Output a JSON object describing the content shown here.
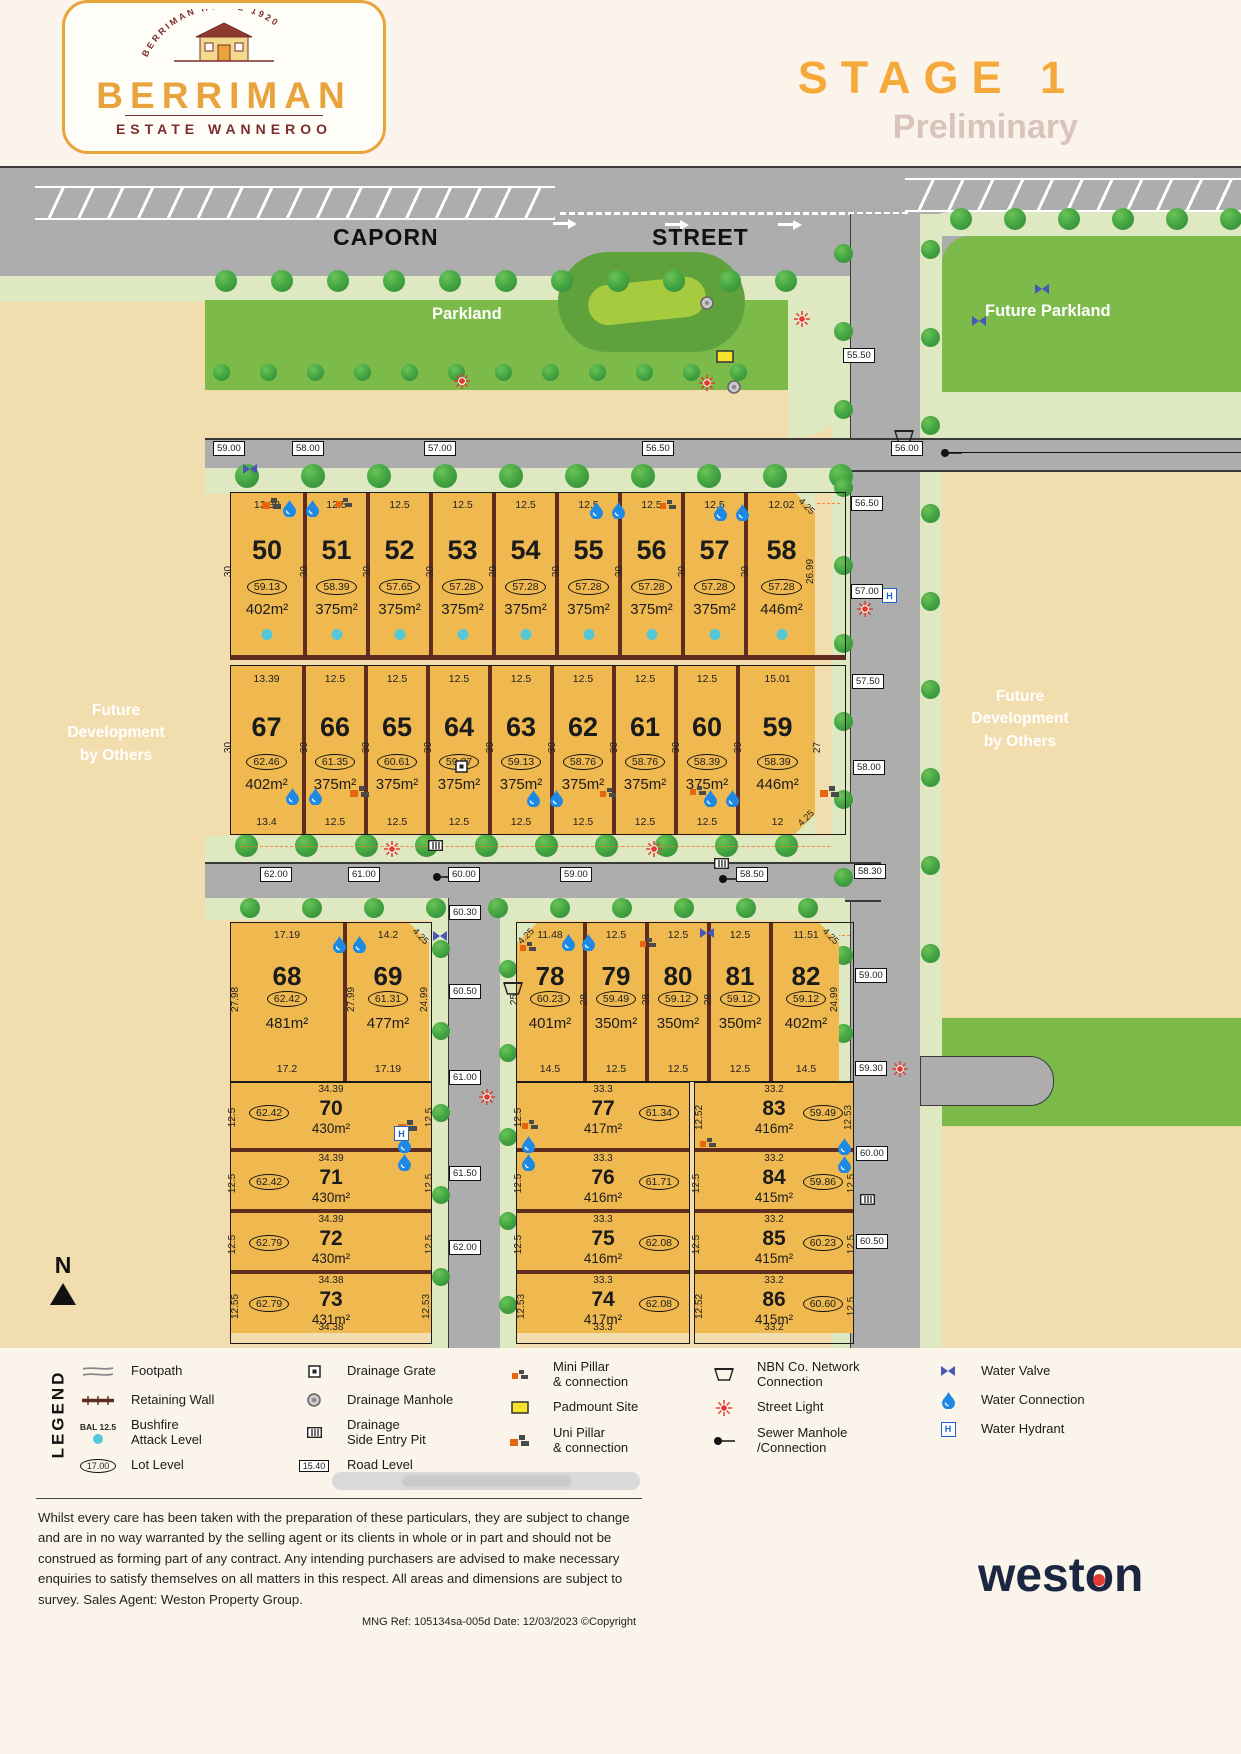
{
  "header": {
    "logo": {
      "arc_text": "BERRIMAN HOUSE 1920",
      "name": "BERRIMAN",
      "subtitle": "ESTATE WANNEROO"
    },
    "stage_title": "STAGE 1",
    "status": "Preliminary"
  },
  "streets": {
    "name_left": "CAPORN",
    "name_right": "STREET"
  },
  "labels": {
    "parkland": "Parkland",
    "future_parkland": "Future Parkland",
    "future_dev": [
      "Future",
      "Development",
      "by Others"
    ],
    "north": "N"
  },
  "road_levels": {
    "ne": "55.50",
    "top_road": [
      "59.00",
      "58.00",
      "57.00",
      "56.50",
      "56.00"
    ],
    "right_road": [
      "56.50",
      "57.00",
      "57.50",
      "58.00",
      "58.30",
      "59.00",
      "59.30",
      "60.00",
      "60.50"
    ],
    "mid_road": [
      "62.00",
      "61.00",
      "60.00",
      "59.00",
      "58.50"
    ],
    "central_road": [
      "60.30",
      "60.50",
      "61.00",
      "61.50",
      "62.00"
    ]
  },
  "lots": {
    "row_top": [
      {
        "num": "50",
        "top": "13.38",
        "left_side": "30",
        "level": "59.13",
        "area": "402m²"
      },
      {
        "num": "51",
        "top": "12.5",
        "left_side": "30",
        "level": "58.39",
        "area": "375m²"
      },
      {
        "num": "52",
        "top": "12.5",
        "left_side": "30",
        "level": "57.65",
        "area": "375m²"
      },
      {
        "num": "53",
        "top": "12.5",
        "left_side": "30",
        "level": "57.28",
        "area": "375m²"
      },
      {
        "num": "54",
        "top": "12.5",
        "left_side": "30",
        "level": "57.28",
        "area": "375m²"
      },
      {
        "num": "55",
        "top": "12.5",
        "left_side": "30",
        "level": "57.28",
        "area": "375m²"
      },
      {
        "num": "56",
        "top": "12.5",
        "left_side": "30",
        "level": "57.28",
        "area": "375m²"
      },
      {
        "num": "57",
        "top": "12.5",
        "left_side": "30",
        "level": "57.28",
        "area": "375m²"
      },
      {
        "num": "58",
        "top": "12.02",
        "left_side": "30",
        "right_side": "26.99",
        "corner": "4.25",
        "corner_pos": "tr",
        "level": "57.28",
        "area": "446m²"
      }
    ],
    "row_second": [
      {
        "num": "67",
        "top": "13.39",
        "bottom": "13.4",
        "left_side": "30",
        "right_side": "30",
        "level": "62.46",
        "area": "402m²"
      },
      {
        "num": "66",
        "top": "12.5",
        "bottom": "12.5",
        "right_side": "30",
        "level": "61.35",
        "area": "375m²"
      },
      {
        "num": "65",
        "top": "12.5",
        "bottom": "12.5",
        "right_side": "30",
        "level": "60.61",
        "area": "375m²"
      },
      {
        "num": "64",
        "top": "12.5",
        "bottom": "12.5",
        "right_side": "30",
        "level": "59.87",
        "area": "375m²"
      },
      {
        "num": "63",
        "top": "12.5",
        "bottom": "12.5",
        "right_side": "30",
        "level": "59.13",
        "area": "375m²"
      },
      {
        "num": "62",
        "top": "12.5",
        "bottom": "12.5",
        "right_side": "30",
        "level": "58.76",
        "area": "375m²"
      },
      {
        "num": "61",
        "top": "12.5",
        "bottom": "12.5",
        "right_side": "30",
        "level": "58.76",
        "area": "375m²"
      },
      {
        "num": "60",
        "top": "12.5",
        "bottom": "12.5",
        "right_side": "30",
        "level": "58.39",
        "area": "375m²"
      },
      {
        "num": "59",
        "top": "15.01",
        "bottom": "12",
        "right_side": "27",
        "corner": "4.25",
        "corner_pos": "br",
        "level": "58.39",
        "area": "446m²"
      }
    ],
    "block_68_69": [
      {
        "num": "68",
        "top": "17.19",
        "bottom": "17.2",
        "left_side": "27.98",
        "level": "62.42",
        "area": "481m²"
      },
      {
        "num": "69",
        "top": "14.2",
        "bottom": "17.19",
        "left_side": "27.99",
        "right_side": "24.99",
        "corner": "4.25",
        "corner_pos": "tr",
        "level": "61.31",
        "area": "477m²"
      }
    ],
    "row_78_82": [
      {
        "num": "78",
        "top": "11.48",
        "bottom": "14.5",
        "left_side": "25",
        "corner": "4.25",
        "corner_pos": "tl",
        "level": "60.23",
        "area": "401m²"
      },
      {
        "num": "79",
        "top": "12.5",
        "bottom": "12.5",
        "left_side": "28",
        "level": "59.49",
        "area": "350m²"
      },
      {
        "num": "80",
        "top": "12.5",
        "bottom": "12.5",
        "left_side": "28",
        "level": "59.12",
        "area": "350m²"
      },
      {
        "num": "81",
        "top": "12.5",
        "bottom": "12.5",
        "left_side": "28",
        "level": "59.12",
        "area": "350m²"
      },
      {
        "num": "82",
        "top": "11.51",
        "bottom": "14.5",
        "right_side": "24.99",
        "corner": "4.25",
        "corner_pos": "tr",
        "level": "59.12",
        "area": "402m²"
      }
    ],
    "col_left": [
      {
        "num": "70",
        "top": "34.39",
        "left_side": "12.5",
        "right_side": "12.5",
        "level": "62.42",
        "area": "430m²"
      },
      {
        "num": "71",
        "top": "34.39",
        "left_side": "12.5",
        "right_side": "12.5",
        "level": "62.42",
        "area": "430m²"
      },
      {
        "num": "72",
        "top": "34.39",
        "left_side": "12.5",
        "right_side": "12.5",
        "level": "62.79",
        "area": "430m²"
      },
      {
        "num": "73",
        "top": "34.38",
        "bottom": "34.38",
        "left_side": "12.55",
        "right_side": "12.53",
        "level": "62.79",
        "area": "431m²"
      }
    ],
    "col_center": [
      {
        "num": "77",
        "top": "33.3",
        "left_side": "12.5",
        "level": "61.34",
        "area": "417m²"
      },
      {
        "num": "76",
        "top": "33.3",
        "left_side": "12.5",
        "level": "61.71",
        "area": "416m²"
      },
      {
        "num": "75",
        "top": "33.3",
        "left_side": "12.5",
        "level": "62.08",
        "area": "416m²"
      },
      {
        "num": "74",
        "top": "33.3",
        "bottom": "33.3",
        "left_side": "12.53",
        "level": "62.08",
        "area": "417m²"
      }
    ],
    "col_right": [
      {
        "num": "83",
        "top": "33.2",
        "left_side": "12.52",
        "right_side": "12.53",
        "level": "59.49",
        "area": "416m²"
      },
      {
        "num": "84",
        "top": "33.2",
        "left_side": "12.5",
        "right_side": "12.5",
        "level": "59.86",
        "area": "415m²"
      },
      {
        "num": "85",
        "top": "33.2",
        "left_side": "12.5",
        "right_side": "12.5",
        "level": "60.23",
        "area": "415m²"
      },
      {
        "num": "86",
        "top": "33.2",
        "bottom": "33.2",
        "left_side": "12.52",
        "right_side": "12.5",
        "level": "60.60",
        "area": "415m²"
      }
    ]
  },
  "legend": {
    "title": "LEGEND",
    "columns": [
      [
        {
          "icon": "footpath-icon",
          "label": "Footpath"
        },
        {
          "icon": "retaining-wall-icon",
          "label": "Retaining Wall"
        },
        {
          "icon": "bal-icon",
          "pre": "BAL 12.5",
          "label": "Bushfire\nAttack Level"
        },
        {
          "icon": "lot-level-icon",
          "badge": "17.00",
          "label": "Lot Level"
        }
      ],
      [
        {
          "icon": "drainage-grate-icon",
          "label": "Drainage Grate"
        },
        {
          "icon": "drainage-manhole-icon",
          "label": "Drainage Manhole"
        },
        {
          "icon": "drainage-sep-icon",
          "label": "Drainage\nSide Entry Pit"
        },
        {
          "icon": "road-level-icon",
          "badge": "15.40",
          "label": "Road Level"
        }
      ],
      [
        {
          "icon": "mini-pillar-icon",
          "label": "Mini Pillar\n& connection"
        },
        {
          "icon": "padmount-icon",
          "label": "Padmount Site"
        },
        {
          "icon": "uni-pillar-icon",
          "label": "Uni Pillar\n& connection"
        }
      ],
      [
        {
          "icon": "nbn-icon",
          "label": "NBN Co. Network\nConnection"
        },
        {
          "icon": "street-light-icon",
          "label": "Street Light"
        },
        {
          "icon": "sewer-icon",
          "label": "Sewer Manhole\n/Connection"
        }
      ],
      [
        {
          "icon": "water-valve-icon",
          "label": "Water Valve"
        },
        {
          "icon": "water-connection-icon",
          "label": "Water Connection"
        },
        {
          "icon": "water-hydrant-icon",
          "label": "Water Hydrant"
        }
      ]
    ]
  },
  "footer": {
    "disclaimer": "Whilst every care has been taken with the preparation of these particulars, they are subject to change and are in no way warranted by the selling agent or its clients in whole or in part and should not be construed as forming part of any contract. Any intending purchasers are advised to make necessary enquiries to satisfy themselves on all matters in this respect. All areas and dimensions are subject to survey. Sales Agent: Weston Property Group.",
    "ref": "MNG Ref: 105134sa-005d   Date: 12/03/2023   ©Copyright",
    "brand_west": "west",
    "brand_o": "o",
    "brand_n": "n"
  }
}
